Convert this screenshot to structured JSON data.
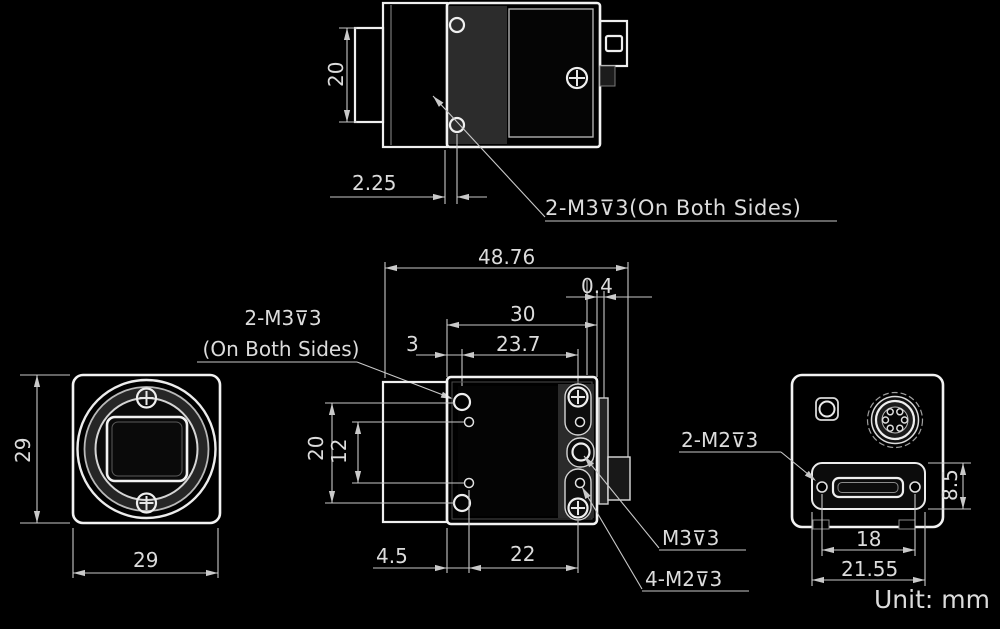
{
  "title": "Camera dimensional drawing",
  "unit": {
    "label": "Unit: mm"
  },
  "annotations": {
    "top_note": "2-M3⊽3(On Both Sides)",
    "side_note_line1": "2-M3⊽3",
    "side_note_line2": "(On Both Sides)",
    "m3_note": "M3⊽3",
    "m2x4_note": "4-M2⊽3",
    "rear_m2_note": "2-M2⊽3"
  },
  "dimensions": {
    "top_view": {
      "width": "20",
      "flange_offset": "2.25"
    },
    "side_view": {
      "total_length": "48.76",
      "rear_gap": "0.4",
      "body_depth": "30",
      "m3_offset": "3",
      "m3_span": "23.7",
      "m3_vertical": "20",
      "m2_vertical": "12",
      "m2_offset": "4.5",
      "m2_span": "22"
    },
    "front_view": {
      "width": "29",
      "height": "29"
    },
    "rear_view": {
      "band_height": "8.5",
      "hole_span": "18",
      "band_width": "21.55"
    }
  },
  "colors": {
    "background": "#000000",
    "outline": "#f0f0f0",
    "dimension_line": "#c9c9c9",
    "text": "#dcdcdc"
  }
}
